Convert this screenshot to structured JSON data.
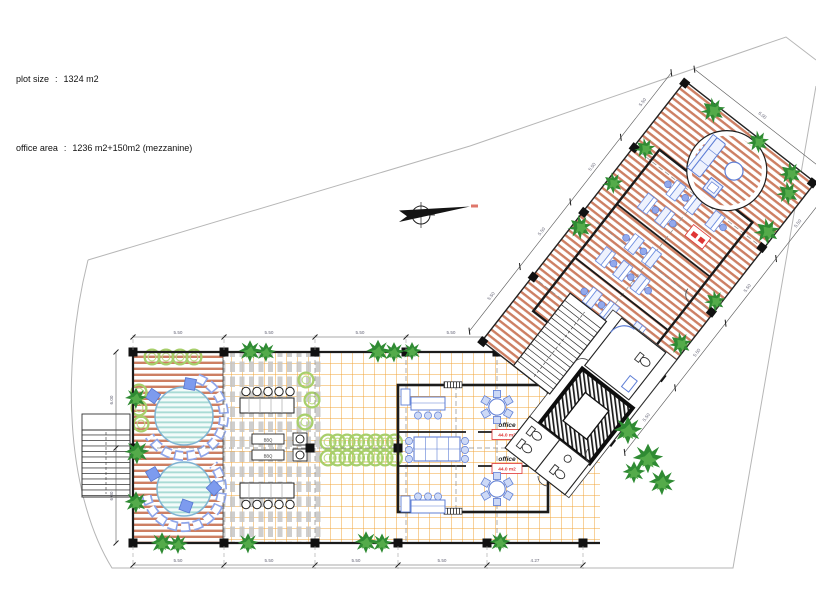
{
  "header": {
    "line1": {
      "label": "plot size",
      "colon": ":",
      "value": "1324 m2"
    },
    "line2": {
      "label": "office area",
      "colon": ":",
      "value": "1236 m2+150m2 (mezzanine)"
    }
  },
  "plan": {
    "offices": [
      {
        "label": "office",
        "area": "44.0 m2"
      },
      {
        "label": "office",
        "area": "44.0 m2"
      }
    ],
    "bbq_labels": [
      "BBQ",
      "BBQ"
    ]
  },
  "dimensions": {
    "bottom": [
      "5.50",
      "5.50",
      "5.50",
      "5.50",
      "4.27"
    ],
    "top": [
      "5.50",
      "5.50",
      "5.50",
      "5.50"
    ],
    "left": [
      "6.00",
      "6.00"
    ],
    "wing_upper": [
      "5.50",
      "5.50",
      "5.50",
      "5.50"
    ],
    "wing_lower": [
      "5.50",
      "5.50",
      "5.50",
      "5.50"
    ],
    "wing_end": "6.00"
  },
  "colors": {
    "deck_stripe": "#cd7f63",
    "tile_grid": "#f0a43a",
    "pergola_slat": "#c6c6c6",
    "pool_stripe": "#a9dbd5",
    "furniture_blue": "#6f8fe0",
    "plant_dark": "#2f8b33",
    "plant_light": "#54ab4a",
    "hedge_green": "#a8cf6b",
    "wall_black": "#1b1b1b",
    "area_label_red": "#e03535",
    "boundary_gray": "#b6b6b6"
  },
  "icons": {
    "north_arrow": "north-arrow-icon",
    "plant": "plant-icon",
    "hedge": "hedge-icon",
    "toilet": "toilet-icon",
    "stairs": "stairs-icon"
  }
}
